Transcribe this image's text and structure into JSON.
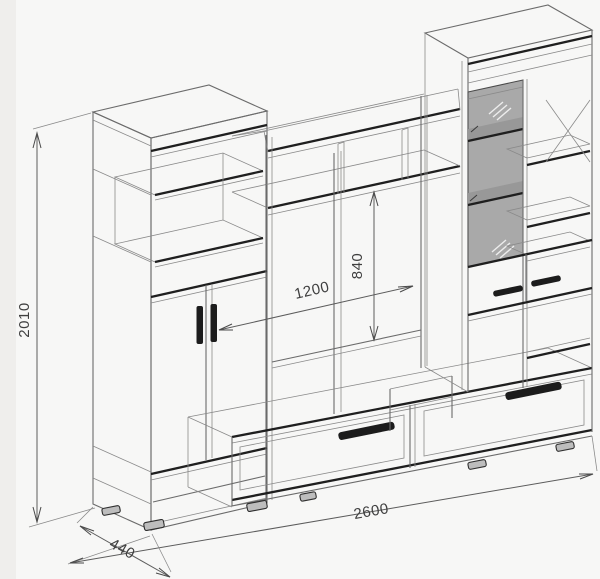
{
  "drawing": {
    "dimensions": {
      "overall_height": "2010",
      "niche_width": "1200",
      "niche_height": "840",
      "overall_width": "2600",
      "depth": "440"
    },
    "colors": {
      "background": "#f7f7f6",
      "line": "#6b6b6b",
      "accent": "#1f1f1f",
      "glass": "#a9a9a9",
      "dimension_text": "#3f3f3f"
    }
  }
}
